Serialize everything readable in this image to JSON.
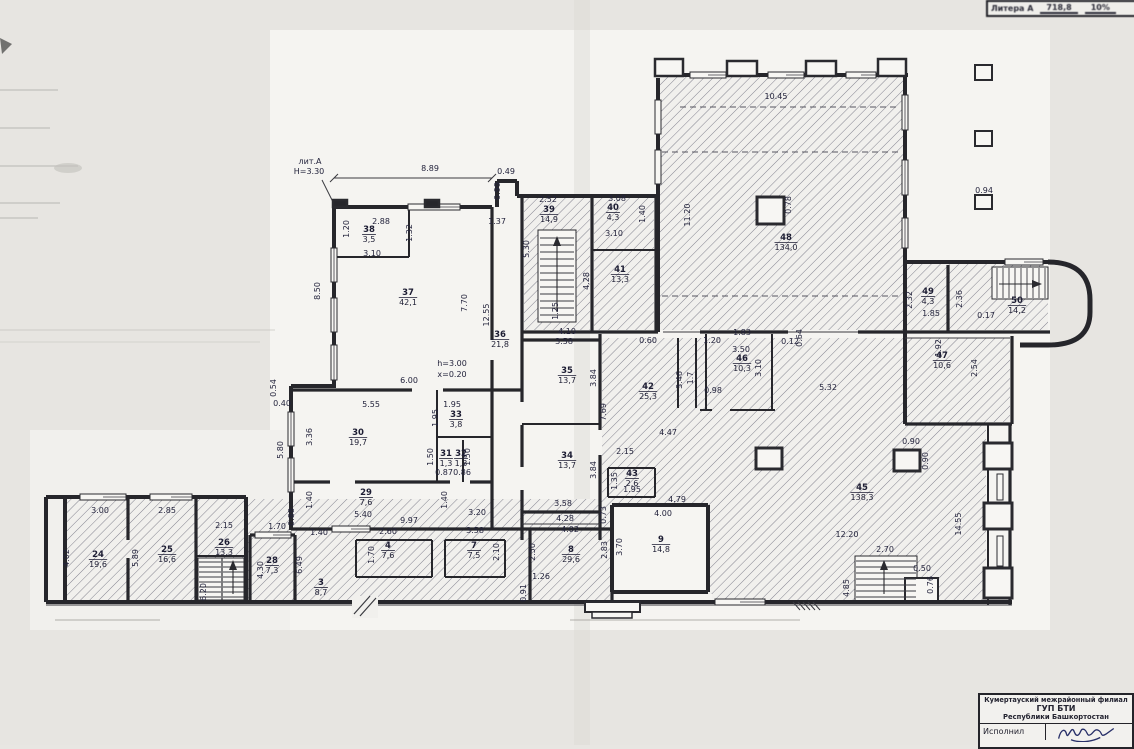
{
  "litera_strip": {
    "label": "Литера А",
    "value1": "718,8",
    "value2": "10%"
  },
  "title_block": {
    "line1": "Кумертауский межрайонный филиал",
    "line2": "ГУП БТИ",
    "line3": "Республики Башкортостан",
    "executor_label": "Исполнил"
  },
  "plan": {
    "rooms": [
      {
        "num": "24",
        "area": "19,6",
        "x": 98,
        "y": 557
      },
      {
        "num": "25",
        "area": "16,6",
        "x": 167,
        "y": 552
      },
      {
        "num": "26",
        "area": "13,3",
        "x": 224,
        "y": 545
      },
      {
        "num": "28",
        "area": "7,3",
        "x": 272,
        "y": 563
      },
      {
        "num": "3",
        "area": "8,7",
        "x": 321,
        "y": 585
      },
      {
        "num": "4",
        "area": "7,6",
        "x": 388,
        "y": 548
      },
      {
        "num": "7",
        "area": "7,5",
        "x": 474,
        "y": 548
      },
      {
        "num": "8",
        "area": "29,6",
        "x": 571,
        "y": 552
      },
      {
        "num": "9",
        "area": "14,8",
        "x": 661,
        "y": 542
      },
      {
        "num": "29",
        "area": "7,6",
        "x": 366,
        "y": 495
      },
      {
        "num": "30",
        "area": "19,7",
        "x": 358,
        "y": 435
      },
      {
        "num": "31",
        "area": "1,3",
        "x": 446,
        "y": 456
      },
      {
        "num": "32",
        "area": "1,3",
        "x": 461,
        "y": 456
      },
      {
        "num": "33",
        "area": "3,8",
        "x": 456,
        "y": 417
      },
      {
        "num": "34",
        "area": "13,7",
        "x": 567,
        "y": 458
      },
      {
        "num": "35",
        "area": "13,7",
        "x": 567,
        "y": 373
      },
      {
        "num": "36",
        "area": "21,8",
        "x": 500,
        "y": 337
      },
      {
        "num": "37",
        "area": "42,1",
        "x": 408,
        "y": 295
      },
      {
        "num": "38",
        "area": "3,5",
        "x": 369,
        "y": 232
      },
      {
        "num": "39",
        "area": "14,9",
        "x": 549,
        "y": 212
      },
      {
        "num": "40",
        "area": "4,3",
        "x": 613,
        "y": 210
      },
      {
        "num": "41",
        "area": "13,3",
        "x": 620,
        "y": 272
      },
      {
        "num": "42",
        "area": "25,3",
        "x": 648,
        "y": 389
      },
      {
        "num": "43",
        "area": "2,6",
        "x": 632,
        "y": 476
      },
      {
        "num": "45",
        "area": "138,3",
        "x": 862,
        "y": 490
      },
      {
        "num": "46",
        "area": "10,3",
        "x": 742,
        "y": 361
      },
      {
        "num": "47",
        "area": "10,6",
        "x": 942,
        "y": 358
      },
      {
        "num": "48",
        "area": "134,0",
        "x": 786,
        "y": 240
      },
      {
        "num": "49",
        "area": "4,3",
        "x": 928,
        "y": 294
      },
      {
        "num": "50",
        "area": "14,2",
        "x": 1017,
        "y": 303
      }
    ],
    "dims": [
      {
        "t": "лит.А",
        "x": 310,
        "y": 164
      },
      {
        "t": "Н=3.30",
        "x": 309,
        "y": 174
      },
      {
        "t": "h=3.00",
        "x": 452,
        "y": 366
      },
      {
        "t": "x=0.20",
        "x": 452,
        "y": 377
      },
      {
        "t": "8.89",
        "x": 430,
        "y": 171
      },
      {
        "t": "0.49",
        "x": 506,
        "y": 174
      },
      {
        "t": "0.99",
        "x": 500,
        "y": 191,
        "r": 1
      },
      {
        "t": "1.37",
        "x": 497,
        "y": 224
      },
      {
        "t": "2.88",
        "x": 381,
        "y": 224
      },
      {
        "t": "1.20",
        "x": 349,
        "y": 229,
        "r": 1
      },
      {
        "t": "1.32",
        "x": 412,
        "y": 233,
        "r": 1
      },
      {
        "t": "3.10",
        "x": 372,
        "y": 256
      },
      {
        "t": "2.52",
        "x": 548,
        "y": 202
      },
      {
        "t": "3.08",
        "x": 617,
        "y": 201
      },
      {
        "t": "1.40",
        "x": 645,
        "y": 214,
        "r": 1
      },
      {
        "t": "3.10",
        "x": 614,
        "y": 236
      },
      {
        "t": "5.30",
        "x": 529,
        "y": 249,
        "r": 1
      },
      {
        "t": "4.28",
        "x": 589,
        "y": 281,
        "r": 1
      },
      {
        "t": "1.25",
        "x": 558,
        "y": 311,
        "r": 1
      },
      {
        "t": "4.10",
        "x": 567,
        "y": 334
      },
      {
        "t": "12.55",
        "x": 489,
        "y": 315,
        "r": 1
      },
      {
        "t": "7.70",
        "x": 467,
        "y": 303,
        "r": 1
      },
      {
        "t": "8.50",
        "x": 320,
        "y": 291,
        "r": 1
      },
      {
        "t": "0.54",
        "x": 276,
        "y": 388,
        "r": 1
      },
      {
        "t": "0.40",
        "x": 282,
        "y": 406
      },
      {
        "t": "6.00",
        "x": 409,
        "y": 383
      },
      {
        "t": "5.55",
        "x": 371,
        "y": 407
      },
      {
        "t": "1.95",
        "x": 452,
        "y": 407
      },
      {
        "t": "1.95",
        "x": 438,
        "y": 418,
        "r": 1
      },
      {
        "t": "3.36",
        "x": 312,
        "y": 437,
        "r": 1
      },
      {
        "t": "5.80",
        "x": 283,
        "y": 450,
        "r": 1
      },
      {
        "t": "1.50",
        "x": 433,
        "y": 457,
        "r": 1
      },
      {
        "t": "0.87",
        "x": 444,
        "y": 475,
        "s": 6.5
      },
      {
        "t": "0.86",
        "x": 462,
        "y": 475,
        "s": 6.5
      },
      {
        "t": "1.50",
        "x": 470,
        "y": 457,
        "r": 1
      },
      {
        "t": "1.40",
        "x": 312,
        "y": 500,
        "r": 1
      },
      {
        "t": "1.40",
        "x": 447,
        "y": 500,
        "r": 1
      },
      {
        "t": "5.40",
        "x": 363,
        "y": 517
      },
      {
        "t": "9.97",
        "x": 409,
        "y": 523
      },
      {
        "t": "3.20",
        "x": 477,
        "y": 515
      },
      {
        "t": "3.58",
        "x": 564,
        "y": 344
      },
      {
        "t": "3.84",
        "x": 596,
        "y": 378,
        "r": 1
      },
      {
        "t": "7.69",
        "x": 606,
        "y": 412,
        "r": 1
      },
      {
        "t": "3.84",
        "x": 596,
        "y": 470,
        "r": 1
      },
      {
        "t": "3.58",
        "x": 563,
        "y": 506
      },
      {
        "t": "4.28",
        "x": 565,
        "y": 521
      },
      {
        "t": "0.73",
        "x": 606,
        "y": 515,
        "r": 1
      },
      {
        "t": "2.15",
        "x": 625,
        "y": 454
      },
      {
        "t": "1.95",
        "x": 632,
        "y": 492,
        "s": 7
      },
      {
        "t": "1.35",
        "x": 617,
        "y": 481,
        "r": 1
      },
      {
        "t": "3.46",
        "x": 682,
        "y": 380,
        "r": 1
      },
      {
        "t": "1.7",
        "x": 693,
        "y": 378,
        "r": 1
      },
      {
        "t": "4.47",
        "x": 668,
        "y": 435
      },
      {
        "t": "0.60",
        "x": 648,
        "y": 343
      },
      {
        "t": "1.20",
        "x": 712,
        "y": 343
      },
      {
        "t": "1.83",
        "x": 742,
        "y": 335
      },
      {
        "t": "3.50",
        "x": 741,
        "y": 352
      },
      {
        "t": "3.10",
        "x": 761,
        "y": 368,
        "r": 1
      },
      {
        "t": "0.12",
        "x": 790,
        "y": 344
      },
      {
        "t": "0.64",
        "x": 802,
        "y": 338,
        "r": 1
      },
      {
        "t": "0.98",
        "x": 713,
        "y": 393
      },
      {
        "t": "5.32",
        "x": 828,
        "y": 390
      },
      {
        "t": "10.45",
        "x": 776,
        "y": 99
      },
      {
        "t": "11.20",
        "x": 690,
        "y": 215,
        "r": 1
      },
      {
        "t": "0.78",
        "x": 791,
        "y": 205,
        "r": 1
      },
      {
        "t": "1.92",
        "x": 941,
        "y": 348,
        "r": 1
      },
      {
        "t": "2.54",
        "x": 977,
        "y": 368,
        "r": 1
      },
      {
        "t": "2.32",
        "x": 912,
        "y": 300,
        "r": 1
      },
      {
        "t": "1.85",
        "x": 931,
        "y": 316
      },
      {
        "t": "2.36",
        "x": 962,
        "y": 299,
        "r": 1
      },
      {
        "t": "0.17",
        "x": 986,
        "y": 318
      },
      {
        "t": "12.20",
        "x": 847,
        "y": 537
      },
      {
        "t": "14.55",
        "x": 961,
        "y": 524,
        "r": 1
      },
      {
        "t": "0.90",
        "x": 911,
        "y": 444
      },
      {
        "t": "0.90",
        "x": 928,
        "y": 461,
        "r": 1
      },
      {
        "t": "2.70",
        "x": 885,
        "y": 552
      },
      {
        "t": "0.50",
        "x": 922,
        "y": 571
      },
      {
        "t": "0.76",
        "x": 933,
        "y": 585,
        "r": 1
      },
      {
        "t": "4.85",
        "x": 849,
        "y": 588,
        "r": 1
      },
      {
        "t": "4.79",
        "x": 677,
        "y": 502
      },
      {
        "t": "4.00",
        "x": 663,
        "y": 516
      },
      {
        "t": "3.70",
        "x": 622,
        "y": 547,
        "r": 1
      },
      {
        "t": "2.83",
        "x": 607,
        "y": 550,
        "r": 1
      },
      {
        "t": "4.02",
        "x": 570,
        "y": 532
      },
      {
        "t": "2.50",
        "x": 535,
        "y": 552,
        "r": 1
      },
      {
        "t": "1.26",
        "x": 541,
        "y": 579
      },
      {
        "t": "0.91",
        "x": 526,
        "y": 593,
        "r": 1
      },
      {
        "t": "3.58",
        "x": 475,
        "y": 533
      },
      {
        "t": "2.10",
        "x": 499,
        "y": 552,
        "r": 1
      },
      {
        "t": "1.40",
        "x": 319,
        "y": 535
      },
      {
        "t": "2.60",
        "x": 388,
        "y": 534
      },
      {
        "t": "1.70",
        "x": 374,
        "y": 555,
        "r": 1
      },
      {
        "t": "3.00",
        "x": 100,
        "y": 513
      },
      {
        "t": "2.85",
        "x": 167,
        "y": 513
      },
      {
        "t": "4.02",
        "x": 69,
        "y": 558,
        "r": 1
      },
      {
        "t": "5.89",
        "x": 138,
        "y": 558,
        "r": 1
      },
      {
        "t": "2.15",
        "x": 224,
        "y": 528
      },
      {
        "t": "6.20",
        "x": 206,
        "y": 592,
        "r": 1
      },
      {
        "t": "1.70",
        "x": 277,
        "y": 529
      },
      {
        "t": "4.30",
        "x": 263,
        "y": 570,
        "r": 1
      },
      {
        "t": "0.88",
        "x": 294,
        "y": 517,
        "r": 1
      },
      {
        "t": "6.49",
        "x": 302,
        "y": 565,
        "r": 1
      },
      {
        "t": "0.94",
        "x": 984,
        "y": 193,
        "s": 7
      }
    ]
  }
}
